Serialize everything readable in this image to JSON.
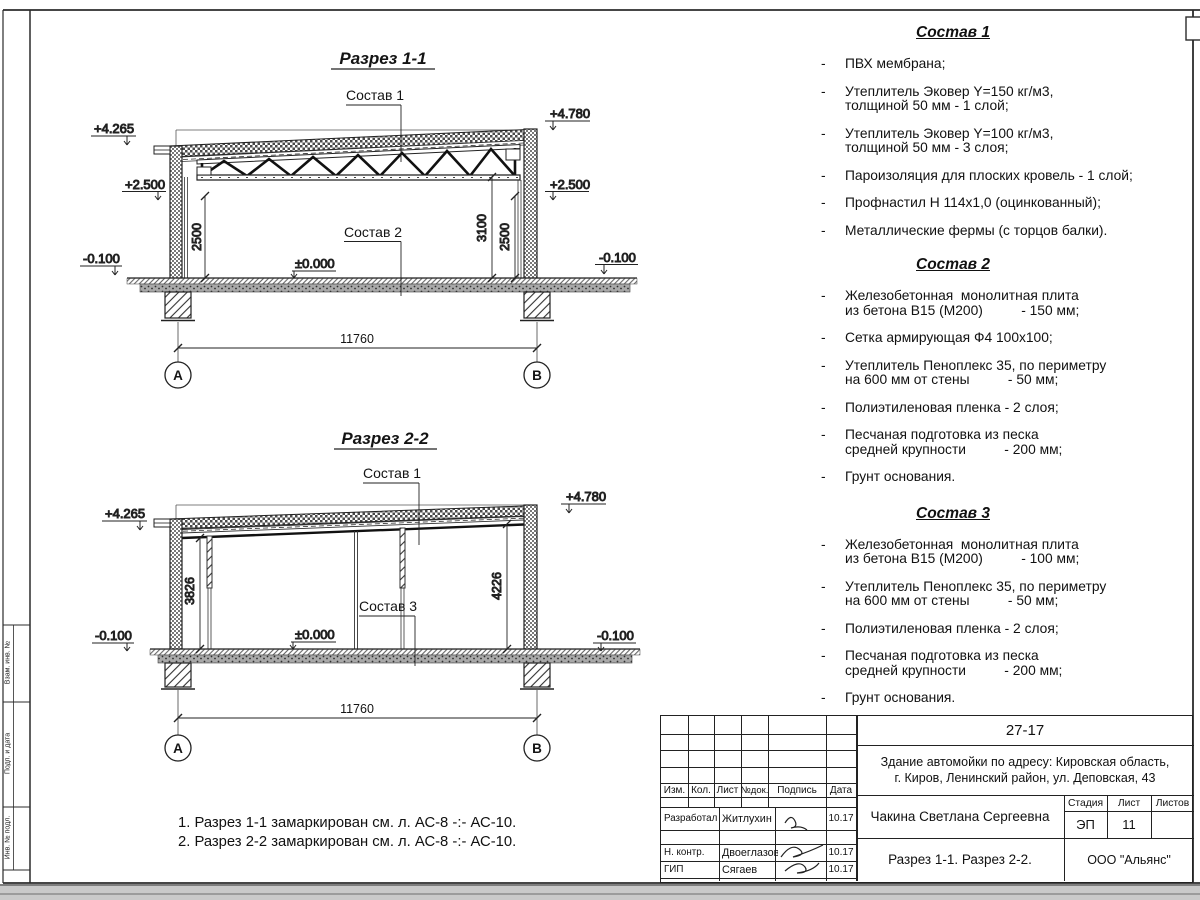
{
  "bullet": "-",
  "side_strip": {
    "label1": "Взам. инв. №",
    "label2": "Подп. и дата",
    "label3": "Инв. № подл."
  },
  "section1": {
    "title": "Разрез 1-1",
    "callout_top": "Состав 1",
    "callout_floor": "Состав 2",
    "elev_top_left": "+4.265",
    "elev_top_right": "+4.780",
    "elev_mid_left": "+2.500",
    "elev_mid_right": "+2.500",
    "elev_zero": "±0.000",
    "elev_low_left": "-0.100",
    "elev_low_right": "-0.100",
    "dim_left": "2500",
    "dim_right_outer": "3100",
    "dim_right_inner": "2500",
    "dim_span": "11760",
    "axis_left": "А",
    "axis_right": "В"
  },
  "section2": {
    "title": "Разрез 2-2",
    "callout_top": "Состав 1",
    "callout_floor": "Состав 3",
    "elev_top_left": "+4.265",
    "elev_top_right": "+4.780",
    "elev_zero": "±0.000",
    "elev_low_left": "-0.100",
    "elev_low_right": "-0.100",
    "dim_left": "3826",
    "dim_right": "4226",
    "dim_span": "11760",
    "axis_left": "А",
    "axis_right": "В"
  },
  "compositions": [
    {
      "title": "Состав 1",
      "items": [
        "ПВХ мембрана;",
        "Утеплитель Эковер Y=150 кг/м3,\nтолщиной 50 мм - 1 слой;",
        "Утеплитель Эковер Y=100 кг/м3,\nтолщиной 50 мм - 3 слоя;",
        "Пароизоляция для плоских кровель - 1 слой;",
        "Профнастил Н 114х1,0 (оцинкованный);",
        "Металлические фермы (с торцов балки)."
      ]
    },
    {
      "title": "Состав 2",
      "items": [
        "Железобетонная  монолитная плита\nиз бетона В15 (М200)          - 150 мм;",
        "Сетка армирующая Ф4 100х100;",
        "Утеплитель Пеноплекс 35, по периметру\nна 600 мм от стены          - 50 мм;",
        "Полиэтиленовая пленка - 2 слоя;",
        "Песчаная подготовка из песка\nсредней крупности          - 200 мм;",
        "Грунт основания."
      ]
    },
    {
      "title": "Состав 3",
      "items": [
        "Железобетонная  монолитная плита\nиз бетона В15 (М200)          - 100 мм;",
        "Утеплитель Пеноплекс 35, по периметру\nна 600 мм от стены          - 50 мм;",
        "Полиэтиленовая пленка - 2 слоя;",
        "Песчаная подготовка из песка\nсредней крупности          - 200 мм;",
        "Грунт основания."
      ]
    }
  ],
  "notes": {
    "line1": "1. Разрез 1-1 замаркирован см. л. АС-8 -:- АС-10.",
    "line2": "2. Разрез 2-2 замаркирован см. л. АС-8 -:- АС-10."
  },
  "titleblock": {
    "doc_number": "27-17",
    "object": "Здание автомойки по адресу: Кировская область,\nг. Киров, Ленинский район, ул. Деповская, 43",
    "col_izm": "Изм.",
    "col_kol": "Кол.",
    "col_list": "Лист",
    "col_doc": "№док.",
    "col_sign": "Подпись",
    "col_date": "Дата",
    "row1_role": "Разработал",
    "row1_name": "Житлухин",
    "row1_date": "10.17",
    "row2_role": "Н. контр.",
    "row2_name": "Двоеглазов",
    "row2_date": "10.17",
    "row3_role": "ГИП",
    "row3_name": "Сягаев",
    "row3_date": "10.17",
    "author": "Чакина Светлана Сергеевна",
    "stage_label": "Стадия",
    "sheet_label": "Лист",
    "sheets_label": "Листов",
    "stage": "ЭП",
    "sheet": "11",
    "sheets": "",
    "sheet_title": "Разрез 1-1. Разрез 2-2.",
    "company": "ООО \"Альянс\""
  }
}
